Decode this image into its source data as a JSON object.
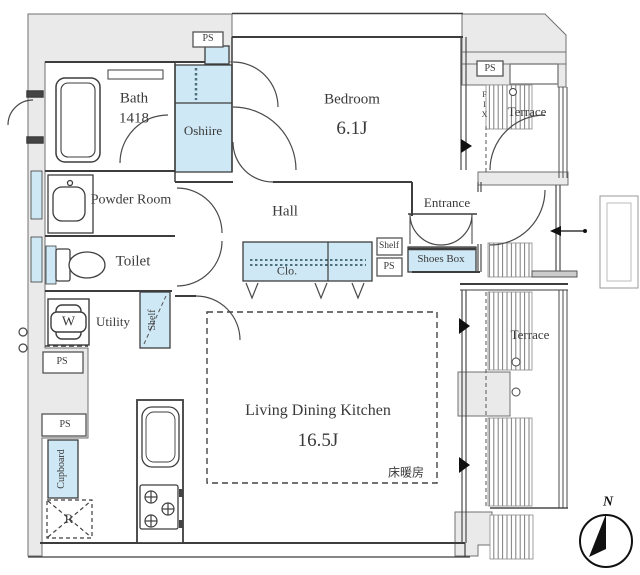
{
  "plan": {
    "rooms": {
      "bath": {
        "label": "Bath",
        "size": "1418"
      },
      "bedroom": {
        "label": "Bedroom",
        "size": "6.1J"
      },
      "powder_room": {
        "label": "Powder Room"
      },
      "toilet": {
        "label": "Toilet"
      },
      "hall": {
        "label": "Hall"
      },
      "entrance": {
        "label": "Entrance"
      },
      "utility": {
        "label": "Utility"
      },
      "ldk": {
        "label": "Living Dining Kitchen",
        "size": "16.5J",
        "floor_heating": "床暖房"
      },
      "terrace_top": {
        "label": "Terrace"
      },
      "terrace_right": {
        "label": "Terrace"
      }
    },
    "storage": {
      "oshiire": {
        "label": "Oshiire"
      },
      "closet": {
        "label": "Clo."
      },
      "shoes_box": {
        "label": "Shoes Box"
      },
      "shelf_hall": {
        "label": "Shelf"
      },
      "shelf_utility": {
        "label": "Shelf"
      },
      "cupboard": {
        "label": "Cupboard"
      },
      "refrigerator": {
        "label": "R"
      }
    },
    "service": {
      "ps_top": "PS",
      "ps_top_right": "PS",
      "ps_mid": "PS",
      "ps_left": "PS",
      "ps_bottom": "PS",
      "washer": "W",
      "fix_window": "FIX"
    },
    "compass": {
      "north_label": "N"
    },
    "colors": {
      "fixture_blue": "#cfe8f5",
      "wall_gray": "#eaeaea",
      "line": "#3d3d3d"
    }
  }
}
